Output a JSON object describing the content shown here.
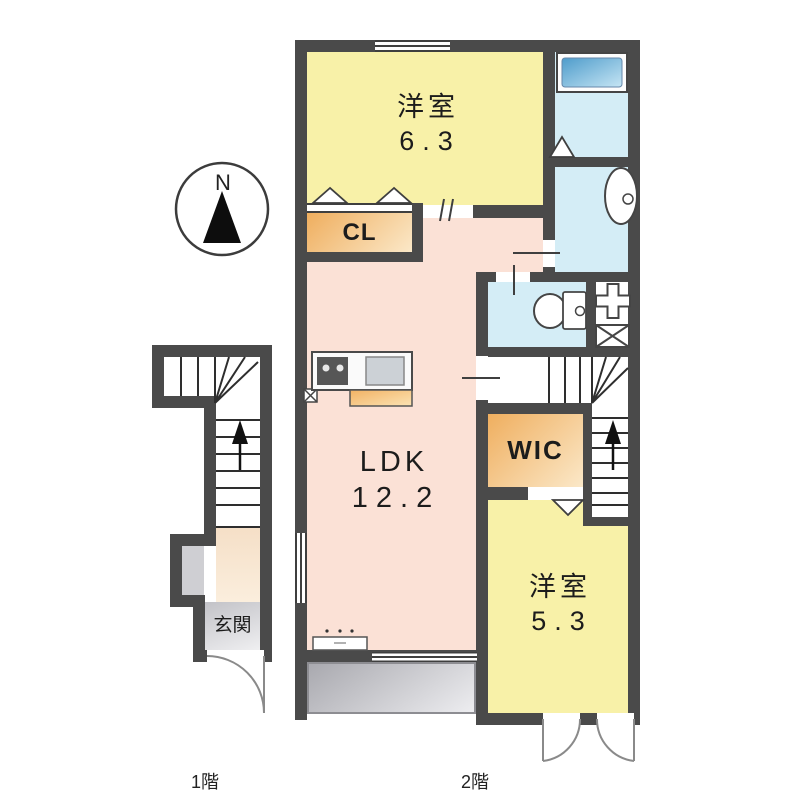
{
  "rooms": {
    "west_room_a": {
      "name": "洋室",
      "area": "6.3"
    },
    "closet": {
      "name": "CL"
    },
    "ldk": {
      "name": "LDK",
      "area": "12.2"
    },
    "wic": {
      "name": "WIC"
    },
    "west_room_b": {
      "name": "洋室",
      "area": "5.3"
    },
    "entrance": {
      "name": "玄関"
    }
  },
  "floor_labels": {
    "first": "1階",
    "second": "2階"
  },
  "compass": {
    "north": "N"
  },
  "icons": {
    "compass": "north-arrow",
    "bath": "bathtub",
    "washroom": "washbasin",
    "toilet": "toilet",
    "laundry": "washing-machine-pan",
    "stairs": "up-arrow",
    "doors": "door-swing-arc"
  },
  "colors": {
    "wall": "#4a4a4a",
    "room_yellow": "#f8f1a8",
    "room_pink": "#fbe1d6",
    "room_orange_1": "#efae5e",
    "room_orange_2": "#fbe8c8",
    "wet_blue": "#d4edf6",
    "bathtub_1": "#4e9ccb",
    "bathtub_2": "#c6e5f4",
    "entrance_gray_1": "#c2c2c7",
    "entrance_gray_2": "#efeff1",
    "balcony_gray_1": "#a9a9af",
    "balcony_gray_2": "#ededf0",
    "hall_cream_1": "#f5dfc7",
    "hall_cream_2": "#fbeedd",
    "outline": "#3f3f3f"
  }
}
